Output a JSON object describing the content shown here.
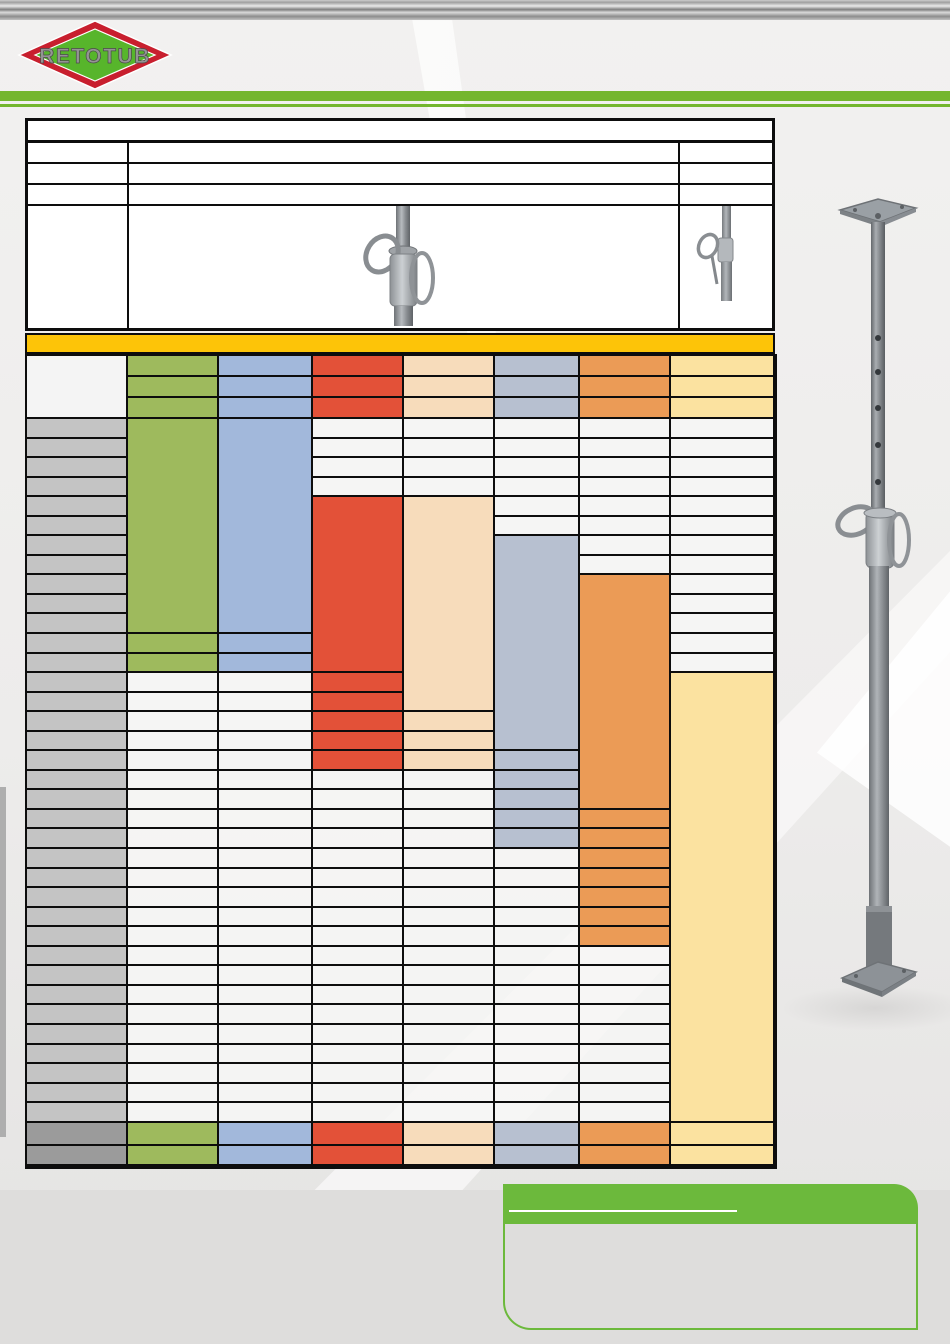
{
  "page": {
    "width": 950,
    "height": 1344,
    "kind": "product-datasheet-blank-template"
  },
  "logo": {
    "text": "RETOTUB",
    "diamond_red": "#C81F2E",
    "diamond_green": "#57B52B",
    "text_fill": "#949494",
    "text_outline": "#4a4a4a"
  },
  "header": {
    "rule_green": "#74B62E"
  },
  "colors": {
    "line": "#0d0d0d",
    "gold": "#FDC408",
    "green": "#9EBA5D",
    "blue": "#A2B8DB",
    "red": "#E35138",
    "peach": "#F7DCBB",
    "bluegray": "#B7C0D0",
    "orange": "#EB9B56",
    "yellowpale": "#FBE2A0",
    "label_gray": "#C4C4C4",
    "footer_gray": "#9B9B9B",
    "cell_light": "rgba(246,246,245,0.82)",
    "header_white": "#F4F4F4",
    "note_green": "#6CB93C"
  },
  "info_table": {
    "row_count": 5,
    "rows": [
      "title-row",
      "spec-row-1",
      "spec-row-2",
      "spec-row-3",
      "image-row"
    ],
    "images": [
      {
        "name": "prop-adjustment-nut-photo"
      },
      {
        "name": "prop-compact-photo"
      }
    ]
  },
  "main_table": {
    "title_band_color": "gold",
    "col_widths_px": [
      101,
      91,
      94,
      91,
      91,
      85,
      91,
      104
    ],
    "header_rows": 3,
    "body_rows": 36,
    "footer_rows": 2,
    "columns": [
      {
        "name": "height-labels",
        "header_color": "header_white",
        "header_merged": true,
        "segments": [
          {
            "rows": 36,
            "color": "label_gray"
          }
        ],
        "footer_color": "footer_gray"
      },
      {
        "name": "series-green",
        "header_color": "green",
        "segments": [
          {
            "rows": 11,
            "color": "green",
            "merged": true
          },
          {
            "rows": 2,
            "color": "green"
          },
          {
            "rows": 23,
            "color": "cell_light"
          }
        ],
        "footer_color": "green"
      },
      {
        "name": "series-blue",
        "header_color": "blue",
        "segments": [
          {
            "rows": 11,
            "color": "blue",
            "merged": true
          },
          {
            "rows": 2,
            "color": "blue"
          },
          {
            "rows": 23,
            "color": "cell_light"
          }
        ],
        "footer_color": "blue"
      },
      {
        "name": "series-red",
        "header_color": "red",
        "segments": [
          {
            "rows": 4,
            "color": "cell_light"
          },
          {
            "rows": 9,
            "color": "red",
            "merged": true
          },
          {
            "rows": 5,
            "color": "red"
          },
          {
            "rows": 18,
            "color": "cell_light"
          }
        ],
        "footer_color": "red"
      },
      {
        "name": "series-peach",
        "header_color": "peach",
        "segments": [
          {
            "rows": 4,
            "color": "cell_light"
          },
          {
            "rows": 11,
            "color": "peach",
            "merged": true
          },
          {
            "rows": 3,
            "color": "peach"
          },
          {
            "rows": 18,
            "color": "cell_light"
          }
        ],
        "footer_color": "peach"
      },
      {
        "name": "series-bluegray",
        "header_color": "bluegray",
        "segments": [
          {
            "rows": 6,
            "color": "cell_light"
          },
          {
            "rows": 11,
            "color": "bluegray",
            "merged": true
          },
          {
            "rows": 5,
            "color": "bluegray"
          },
          {
            "rows": 14,
            "color": "cell_light"
          }
        ],
        "footer_color": "bluegray"
      },
      {
        "name": "series-orange",
        "header_color": "orange",
        "segments": [
          {
            "rows": 8,
            "color": "cell_light"
          },
          {
            "rows": 12,
            "color": "orange",
            "merged": true
          },
          {
            "rows": 7,
            "color": "orange"
          },
          {
            "rows": 9,
            "color": "cell_light"
          }
        ],
        "footer_color": "orange"
      },
      {
        "name": "series-yellow",
        "header_color": "yellowpale",
        "segments": [
          {
            "rows": 13,
            "color": "cell_light"
          },
          {
            "rows": 23,
            "color": "yellowpale",
            "merged": true
          }
        ],
        "footer_color": "yellowpale"
      }
    ]
  },
  "side_figure": {
    "name": "telescopic-prop-photo"
  },
  "green_box": {
    "header_color": "#6CB93C",
    "border_color": "#6CB93C",
    "underline": true
  }
}
